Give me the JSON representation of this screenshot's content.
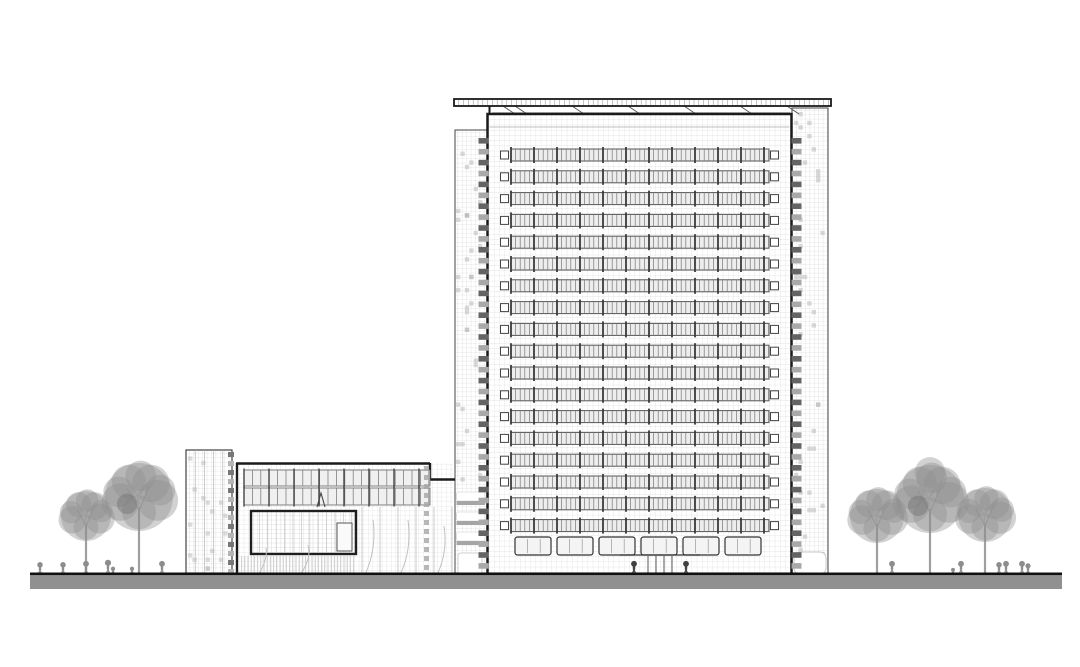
{
  "scene": {
    "type": "architectural-elevation-drawing",
    "width": 1080,
    "height": 667,
    "background": "#ffffff"
  },
  "palette": {
    "outline": "#1a1a1a",
    "line_medium": "#555555",
    "line_light": "#9b9b9b",
    "grid": "#d8d8d8",
    "band_fill": "#ededed",
    "tick": "#3a3a3a",
    "tree": "#8f8f8f",
    "tree_dark": "#707070",
    "person": "#8d8d8d",
    "person_dark": "#3f3f3f",
    "ground_band": "#909090",
    "ground_line": "#111111",
    "white": "#ffffff",
    "shade_cell": "#b9b9b9",
    "stack_dark": "#646464",
    "stack_light": "#a9a9a9"
  },
  "ground": {
    "x1": 30,
    "x2": 1062,
    "y": 574,
    "line_w": 3,
    "band_h": 13
  },
  "roof": {
    "x": 454,
    "y": 99,
    "w": 377,
    "h": 7,
    "tick_step": 4.8,
    "fascia_y": 112.5,
    "fascia_x1": 492,
    "fascia_x2": 790,
    "struts": [
      503,
      515,
      572,
      628,
      684,
      740,
      787
    ]
  },
  "tower": {
    "x": 487.5,
    "y": 114,
    "w": 304,
    "h": 460,
    "parapet_y": 127,
    "bands": {
      "x": 511,
      "w": 258,
      "y0": 149,
      "pitch": 21.8,
      "count": 18,
      "h": 12,
      "tick_step": 4.6,
      "col_step": 23,
      "end_sq_x": [
        500.5,
        770.5
      ]
    },
    "ground_band": {
      "y": 537,
      "h": 18,
      "x0": 515,
      "panel_w": 36,
      "gap": 6,
      "count": 6
    },
    "entrance": {
      "door_x0": 648,
      "door_step": 8,
      "door_count": 4,
      "door_y0": 556,
      "door_y1": 573,
      "canopy_x1": 620,
      "canopy_x2": 700,
      "canopy_y": 555,
      "figures": [
        634,
        686
      ]
    },
    "edge_stacks": {
      "xs": [
        478.5,
        791.5
      ],
      "w": 10,
      "y0": 138,
      "y1": 570,
      "pitch": 10.9,
      "bar_h": 5.6
    }
  },
  "left_wing": {
    "x": 455,
    "y": 130,
    "w": 32.5,
    "louvers_y": [
      492,
      512,
      532
    ],
    "panel": {
      "x": 458,
      "y": 553,
      "w": 24,
      "h": 21
    }
  },
  "right_wing": {
    "x": 792,
    "y": 108,
    "w": 36,
    "canopy": {
      "x": 794,
      "y": 552,
      "w": 32,
      "h": 22
    }
  },
  "podium": {
    "x": 236,
    "y": 463,
    "x2": 455,
    "notch": {
      "x": 430,
      "y2": 479.5
    },
    "bands": [
      {
        "x": 244,
        "y": 470,
        "w": 186,
        "h": 16
      },
      {
        "x": 244,
        "y": 488,
        "w": 186,
        "h": 17
      }
    ],
    "band_tick_step": 8.4,
    "band_col_step": 25,
    "box": {
      "x": 251,
      "y": 511,
      "w": 105,
      "h": 43,
      "inner": {
        "x": 337,
        "y": 523,
        "w": 15,
        "h": 28
      }
    },
    "bay_lines": {
      "x0": 362,
      "x1": 452,
      "step": 18,
      "y0": 507
    },
    "hatch": {
      "x": 240,
      "y": 556,
      "w": 116,
      "h": 18
    },
    "dash_col": {
      "x": 424,
      "y0": 466,
      "y1": 570,
      "pitch": 9,
      "w": 5,
      "h": 5
    },
    "statue": {
      "x": 321,
      "y": 493
    },
    "curves": [
      [
        258,
        575,
        268,
        560,
        266,
        548
      ],
      [
        300,
        575,
        312,
        558,
        308,
        545
      ],
      [
        365,
        575,
        377,
        548,
        373,
        520
      ],
      [
        400,
        575,
        412,
        550,
        408,
        520
      ],
      [
        437,
        575,
        448,
        552,
        444,
        526
      ]
    ]
  },
  "core": {
    "x": 186,
    "y": 450,
    "w": 46,
    "accent": {
      "x": 228,
      "w": 6,
      "pitch": 9,
      "h": 5
    }
  },
  "trees": [
    {
      "cx": 86,
      "cy": 516,
      "r": 25,
      "tall": false,
      "dark": false
    },
    {
      "cx": 139,
      "cy": 497,
      "r": 34,
      "tall": false,
      "dark": true
    },
    {
      "cx": 877,
      "cy": 516,
      "r": 27,
      "tall": false,
      "dark": false
    },
    {
      "cx": 930,
      "cy": 499,
      "r": 34,
      "tall": true,
      "dark": true
    },
    {
      "cx": 985,
      "cy": 515,
      "r": 27,
      "tall": false,
      "dark": false
    }
  ],
  "people": [
    {
      "x": 40,
      "h": 11
    },
    {
      "x": 63,
      "h": 11
    },
    {
      "x": 86,
      "h": 12
    },
    {
      "x": 108,
      "h": 13
    },
    {
      "x": 113,
      "h": 7
    },
    {
      "x": 132,
      "h": 7
    },
    {
      "x": 162,
      "h": 12
    },
    {
      "x": 892,
      "h": 12
    },
    {
      "x": 953,
      "h": 6
    },
    {
      "x": 961,
      "h": 12
    },
    {
      "x": 999,
      "h": 11
    },
    {
      "x": 1006,
      "h": 12
    },
    {
      "x": 1022,
      "h": 12
    },
    {
      "x": 1028,
      "h": 10
    }
  ]
}
